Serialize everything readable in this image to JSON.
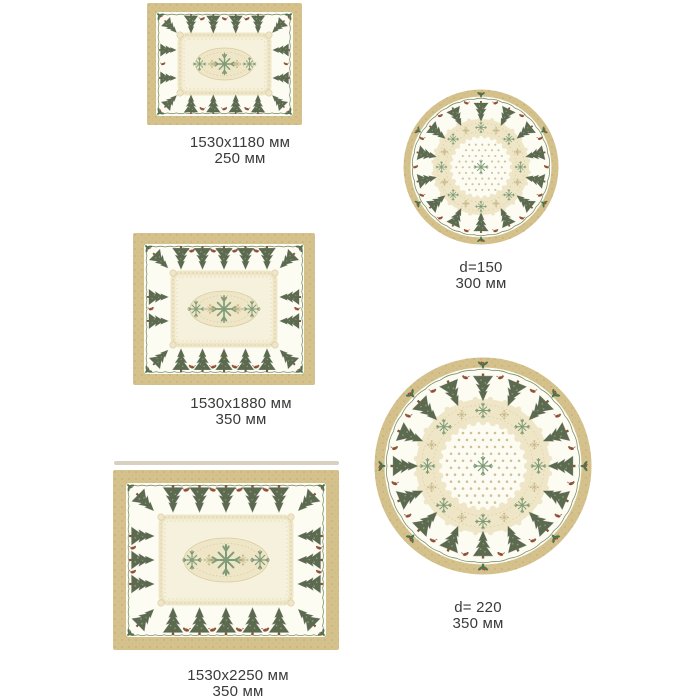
{
  "products": [
    {
      "id": "rect-small",
      "shape": "rectangular tablecloth",
      "size_label": "1530x1180 мм",
      "height_label": "250 мм"
    },
    {
      "id": "round-small",
      "shape": "round tablecloth",
      "size_label": "d=150",
      "height_label": "300 мм"
    },
    {
      "id": "rect-medium",
      "shape": "rectangular tablecloth",
      "size_label": "1530x1880 мм",
      "height_label": "350 мм"
    },
    {
      "id": "round-large",
      "shape": "round tablecloth",
      "size_label": "d= 220",
      "height_label": "350 мм"
    },
    {
      "id": "rect-large",
      "shape": "rectangular tablecloth",
      "size_label": "1530x2250 мм",
      "height_label": "350 мм"
    }
  ],
  "palette": {
    "page_bg": "#ffffff",
    "label_text": "#3a3a3a",
    "border_tan": "#d4c18b",
    "tan_mottle": "#c3ac74",
    "cloth_cream": "#fdfcf3",
    "tree_green": "#5c6b50",
    "tree_shadow": "#49553f",
    "tree_light": "#8fa27e",
    "trunk_brown": "#7a5a3a",
    "lace_beige": "#efe6c8",
    "lace_edge": "#d9cb9e",
    "lace_fill": "#f6f1dd",
    "star_green": "#7f9c78",
    "star_beige": "#c8b98a",
    "dot_beige": "#cfc098",
    "motif_brown": "#8f5a3e",
    "motif_red": "#a83c2b",
    "wave_green": "#7d8e6e",
    "holly_green": "#4a734f",
    "edge_strip": "#d6d1c0"
  }
}
